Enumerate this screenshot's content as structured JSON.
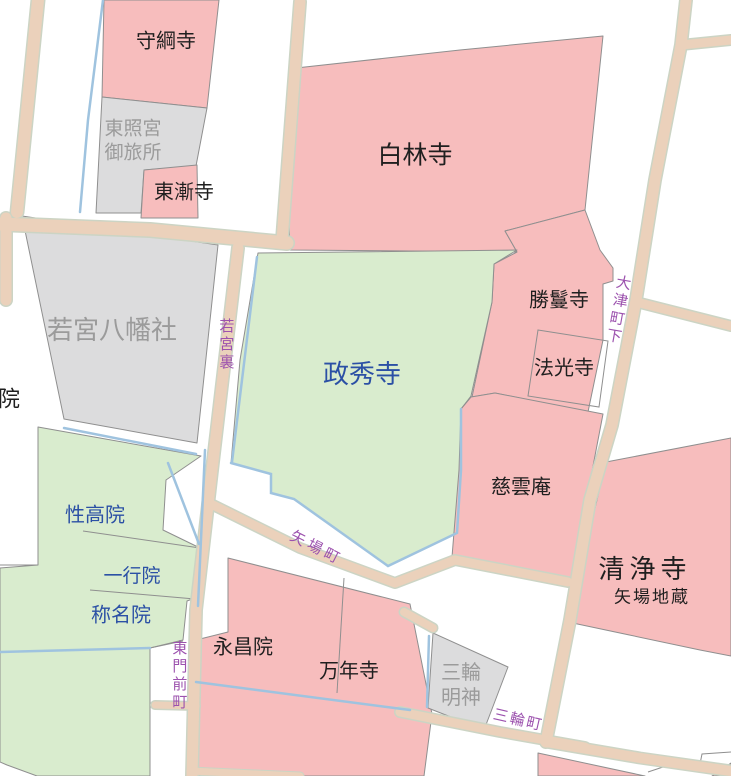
{
  "map": {
    "colors": {
      "background": "#ffffff",
      "temple_pink": "#f7bdbd",
      "temple_green": "#d9ecce",
      "shrine_gray": "#dcdcdd",
      "road_fill": "#ebd1bb",
      "road_casing": "#ccd4c4",
      "parcel_boundary": "#8f8f8f",
      "water_blue": "#9fc3df",
      "label_black": "#1f1f1f",
      "label_blue": "#2b50a5",
      "label_gray": "#9b9b9b",
      "label_purple": "#9c52ae"
    },
    "parcels": [
      {
        "id": "moritsunaji",
        "label": "守綱寺",
        "fill": "pink"
      },
      {
        "id": "otabisho",
        "label": "東照宮御旅所",
        "line1": "東照宮",
        "line2": "御旅所",
        "fill": "gray"
      },
      {
        "id": "tozenji",
        "label": "東漸寺",
        "fill": "pink"
      },
      {
        "id": "hakurinji",
        "label": "白林寺",
        "fill": "pink"
      },
      {
        "id": "shomanji",
        "label": "勝鬘寺",
        "fill": "pink"
      },
      {
        "id": "hokoji",
        "label": "法光寺",
        "fill": "pink"
      },
      {
        "id": "wakamiya",
        "label": "若宮八幡社",
        "fill": "gray"
      },
      {
        "id": "in-clipped",
        "label": "院",
        "fill": "white"
      },
      {
        "id": "seishuji",
        "label": "政秀寺",
        "fill": "green"
      },
      {
        "id": "jiunan",
        "label": "慈雲庵",
        "fill": "pink"
      },
      {
        "id": "shojoji",
        "label": "清浄寺",
        "sublabel": "矢場地蔵",
        "fill": "pink"
      },
      {
        "id": "shokoin",
        "label": "性高院",
        "fill": "green"
      },
      {
        "id": "ichigyoin",
        "label": "一行院",
        "fill": "green"
      },
      {
        "id": "shomyoin",
        "label": "称名院",
        "fill": "green"
      },
      {
        "id": "eishoin",
        "label": "永昌院",
        "fill": "pink"
      },
      {
        "id": "mannenji",
        "label": "万年寺",
        "fill": "pink"
      },
      {
        "id": "miwamyojin",
        "label": "三輪明神",
        "line1": "三輪",
        "line2": "明神",
        "fill": "gray"
      }
    ],
    "streets": [
      {
        "id": "wakamiyaura",
        "label": "若宮裏",
        "orientation": "vertical"
      },
      {
        "id": "otsumachishita",
        "label": "大津町下",
        "orientation": "vertical"
      },
      {
        "id": "yabacho",
        "label": "矢場町",
        "orientation": "diagonal"
      },
      {
        "id": "higashimonzencho",
        "label": "東門前町",
        "orientation": "vertical"
      },
      {
        "id": "miwacho",
        "label": "三輪町",
        "orientation": "diagonal"
      }
    ]
  }
}
